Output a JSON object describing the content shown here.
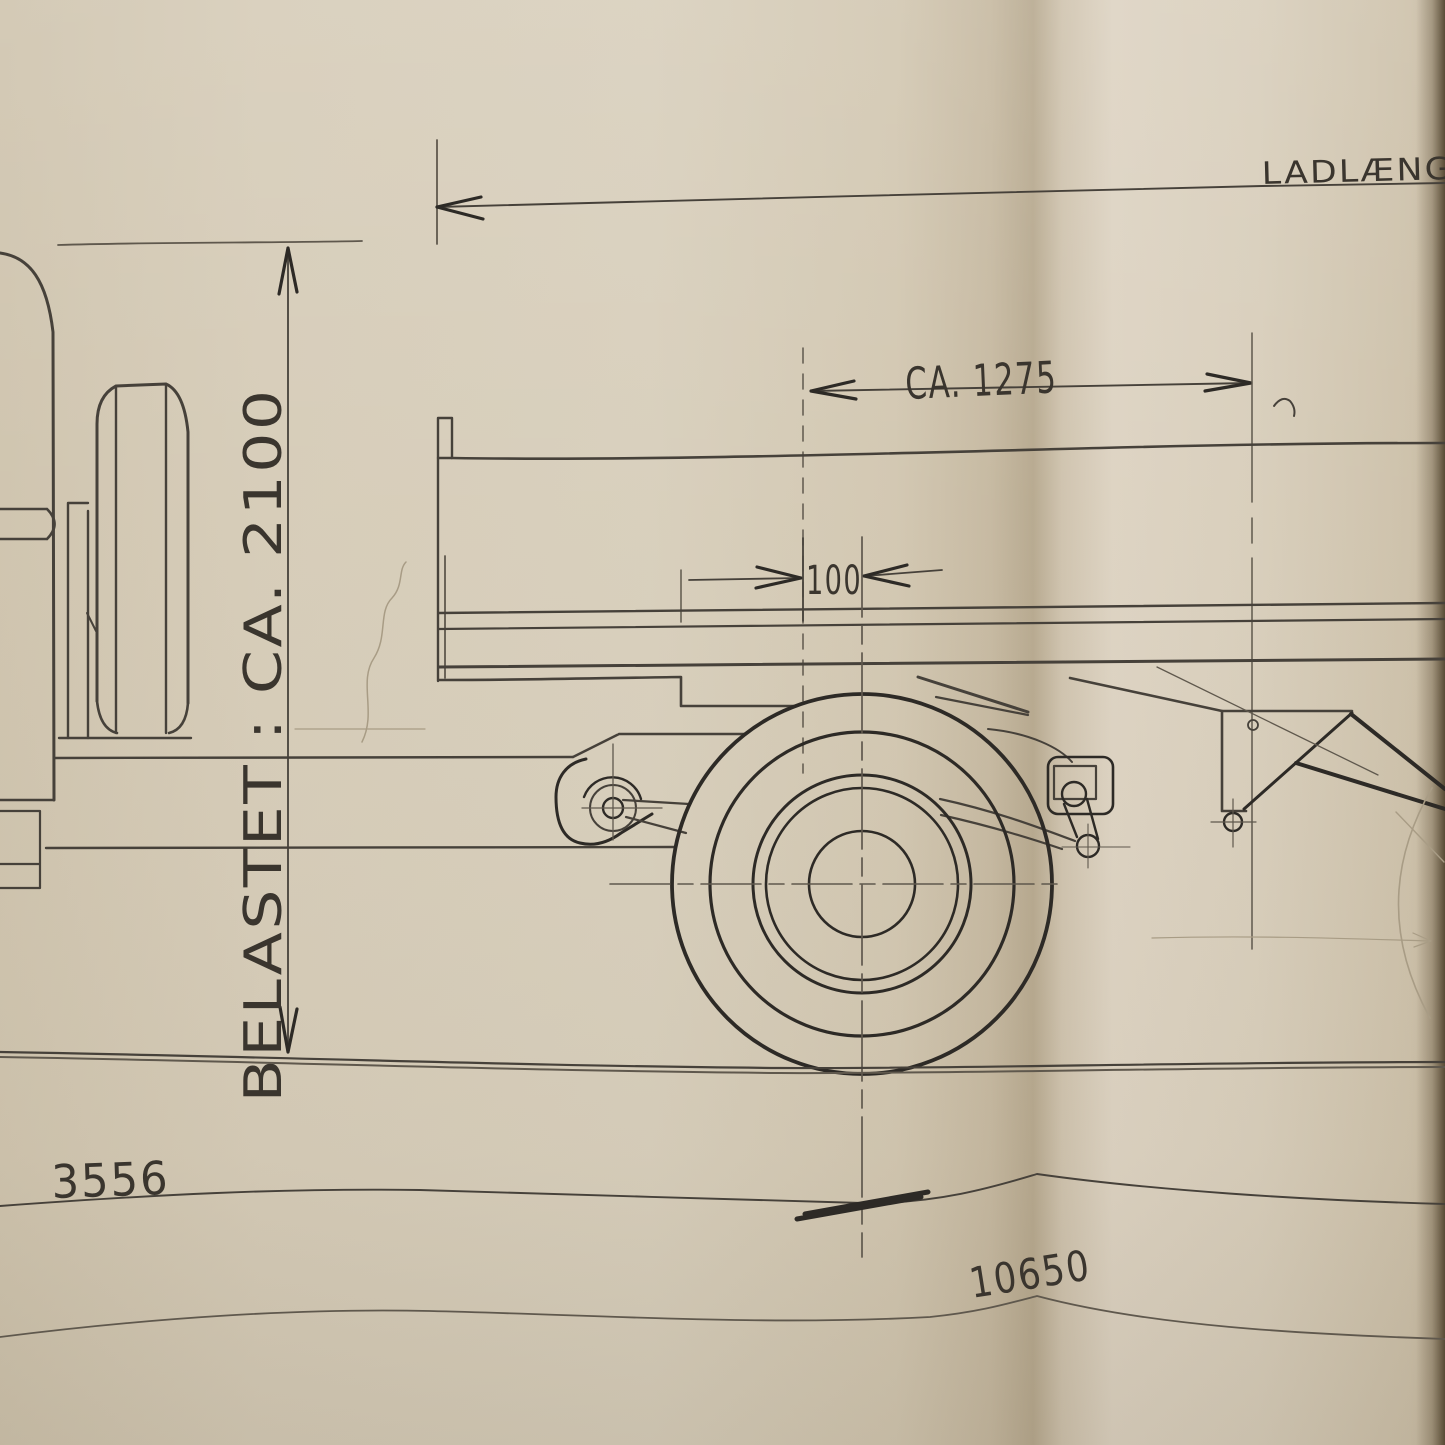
{
  "drawing": {
    "kind": "hand-drawn pencil engineering drawing of a flatbed truck, photographed on folded beige paper",
    "labels": {
      "load_length_label": "LADLÆNG",
      "loaded_height_label": "BELASTET : CA. 2100",
      "platform_dim_label": "CA. 1275",
      "offset_dim_label": "100",
      "left_length_label": "3556",
      "overall_length_label": "10650"
    },
    "colors": {
      "paper_light": "#d9cfbc",
      "paper_mid": "#d3c8b3",
      "paper_shadow": "#c0b299",
      "fold_dark": "#b7a98f",
      "edge_dark": "#5e5038",
      "pencil_bold": "#2d2a26",
      "pencil_main": "#46413a",
      "pencil_light": "#5f584d",
      "pencil_faint": "#a89c85",
      "pencil_text": "#3a352e"
    }
  }
}
